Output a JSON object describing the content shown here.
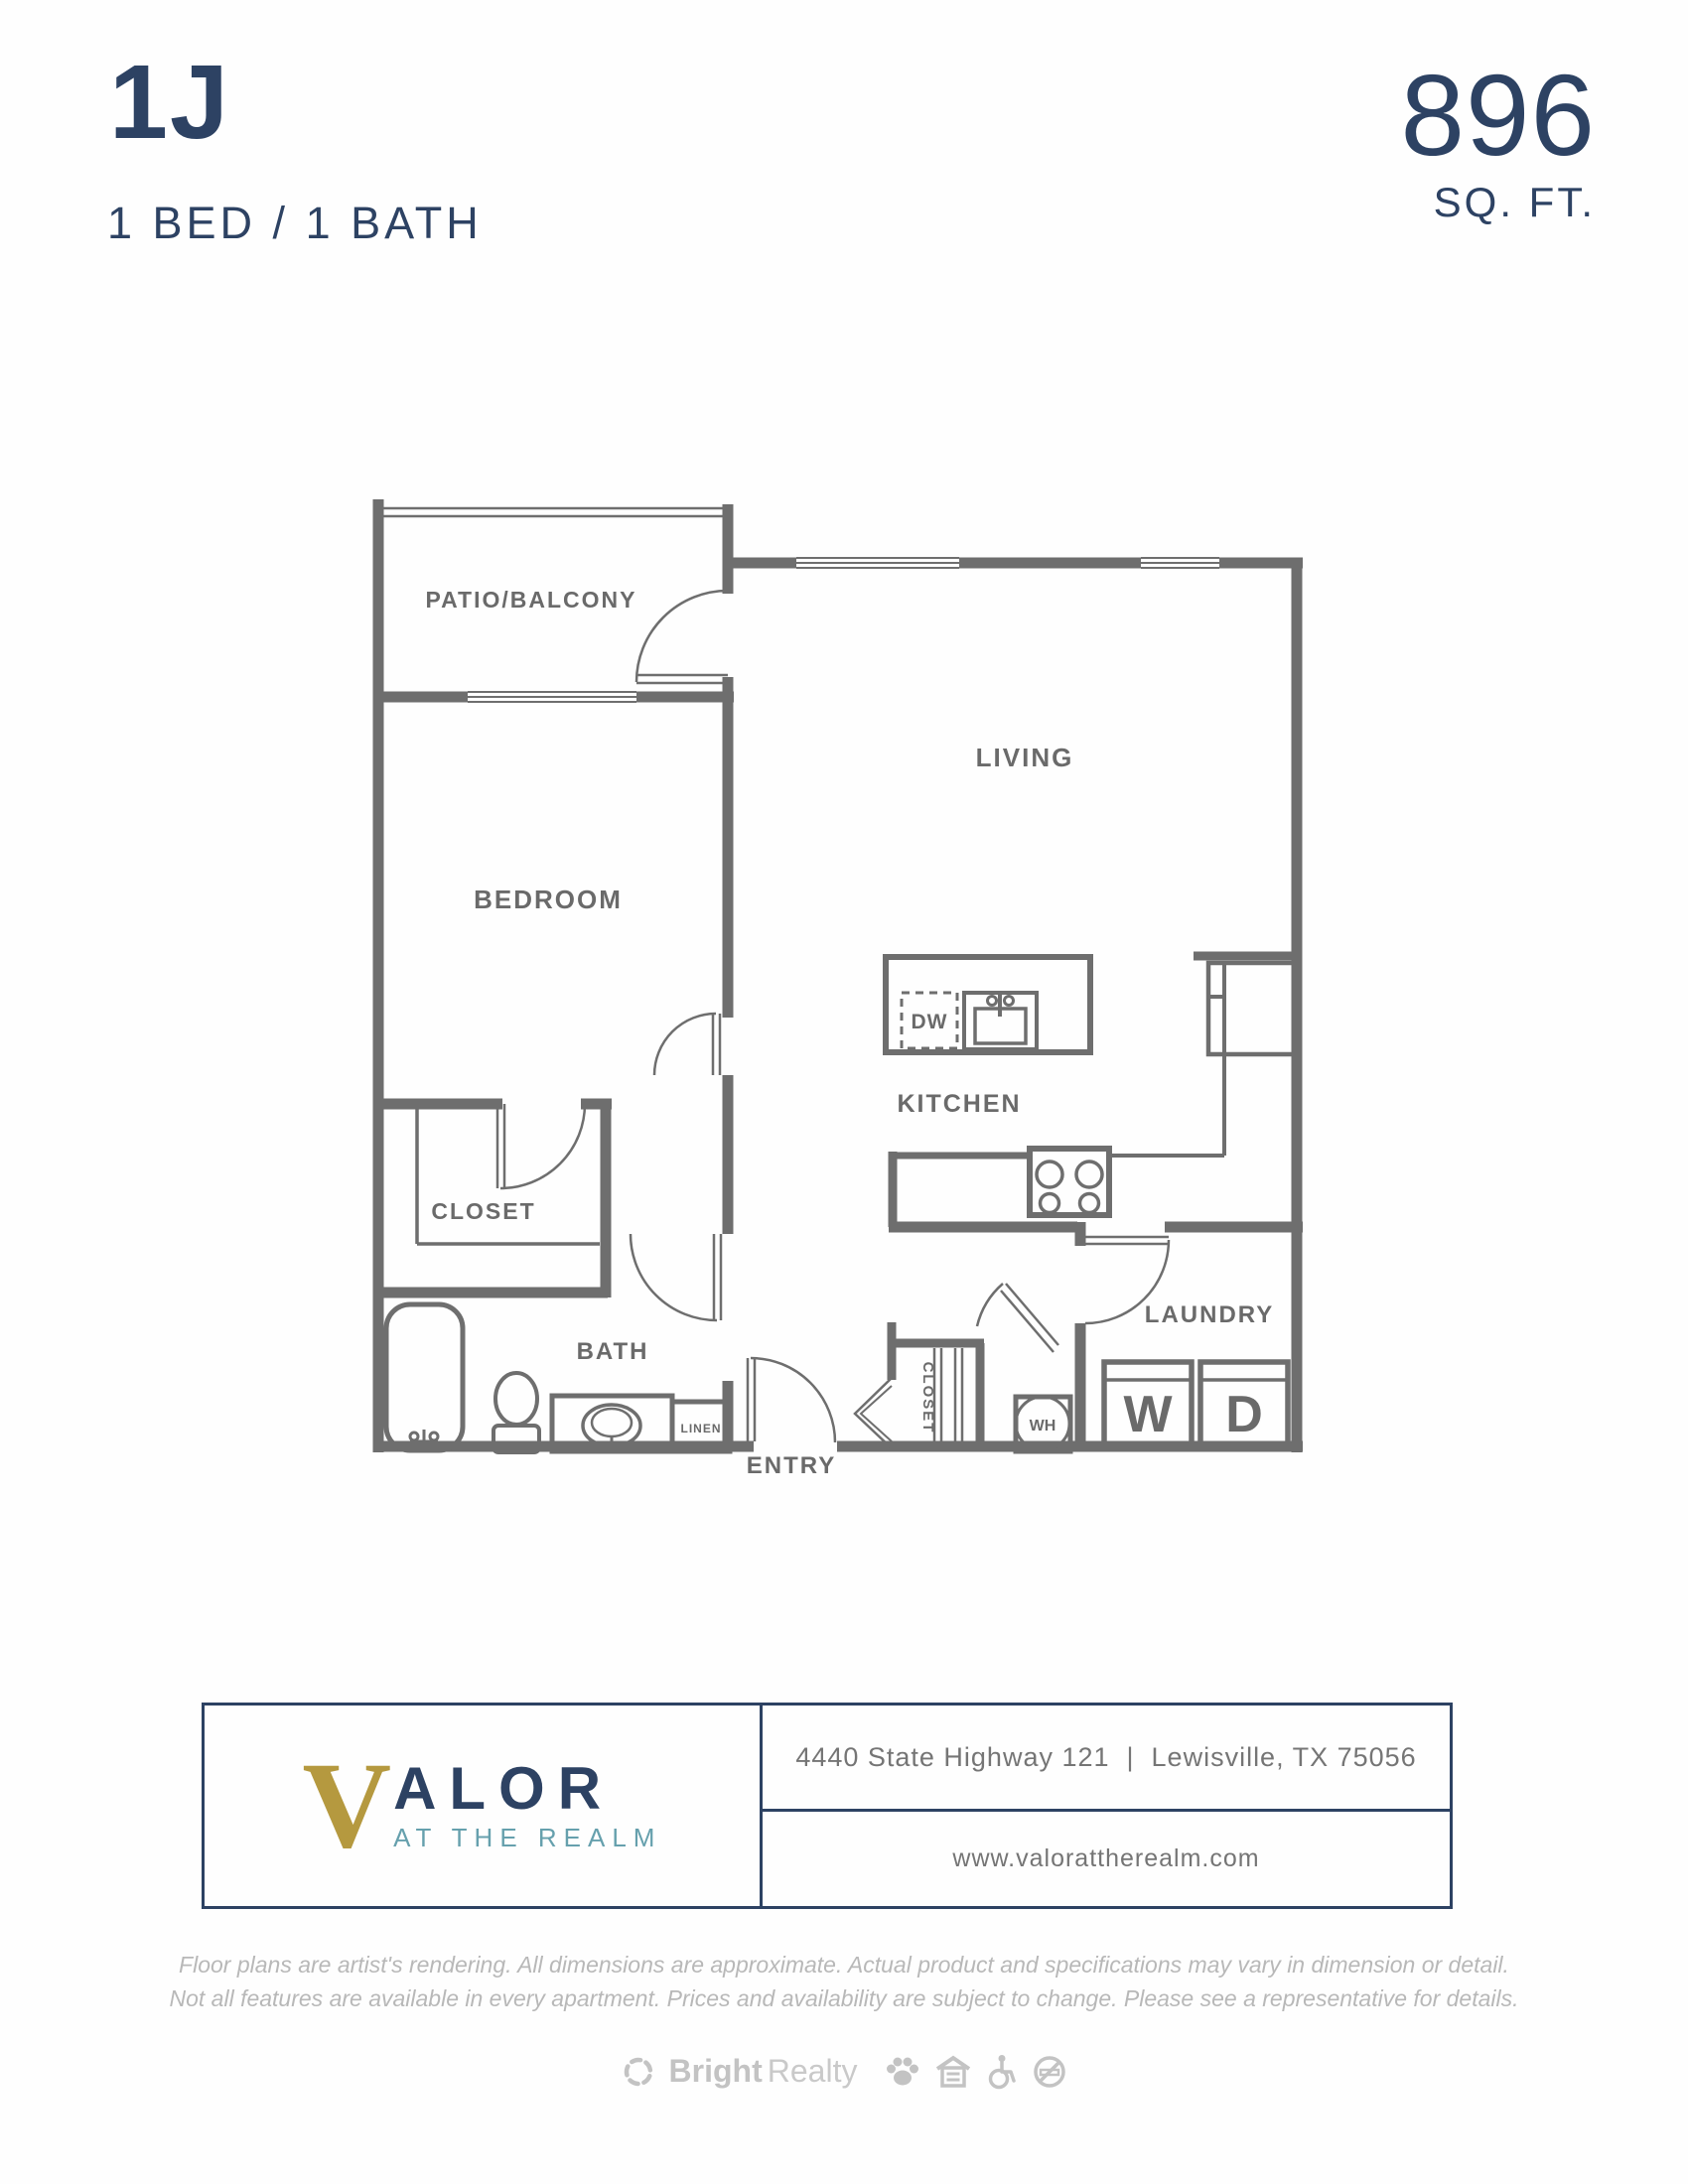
{
  "header": {
    "unit": "1J",
    "spec": "1 BED / 1 BATH",
    "area": "896",
    "area_unit": "SQ. FT."
  },
  "plan": {
    "rooms": {
      "patio": "PATIO/BALCONY",
      "living": "LIVING",
      "bedroom": "BEDROOM",
      "kitchen": "KITCHEN",
      "bedroom_closet": "CLOSET",
      "bath": "BATH",
      "entry": "ENTRY",
      "entry_closet": "CLOSET",
      "laundry": "LAUNDRY",
      "linen": "LINEN"
    },
    "fixtures": {
      "dishwasher": "DW",
      "water_heater": "WH",
      "washer": "W",
      "dryer": "D"
    }
  },
  "footer": {
    "logo": {
      "initial": "V",
      "wordmark_rest": "ALOR",
      "tagline": "AT THE REALM"
    },
    "address": "4440 State Highway 121  |  Lewisville, TX 75056",
    "website": "www.valorattherealm.com",
    "disclaimer_line1": "Floor plans are artist's rendering. All dimensions are approximate. Actual product and specifications may vary in dimension or detail.",
    "disclaimer_line2": "Not all features are available in every apartment. Prices and availability are subject to change. Please see a representative for details.",
    "brand": {
      "name_bold": "Bright",
      "name_light": "Realty"
    }
  },
  "colors": {
    "navy": "#2d4263",
    "wall_gray": "#6e6e6e",
    "label_gray": "#6a6a6a",
    "gold": "#b5993f",
    "teal": "#66a0ad",
    "disclaimer_gray": "#b8b8b8",
    "brand_gray": "#c3c3c3"
  }
}
